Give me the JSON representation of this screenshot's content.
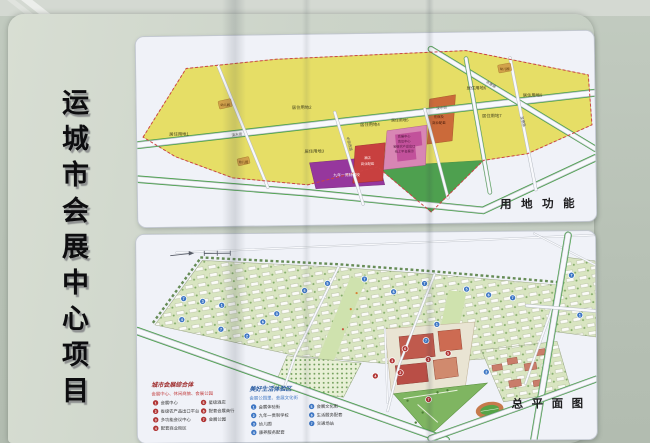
{
  "board": {
    "title": "运城市会展中心项目"
  },
  "land_use": {
    "panel_title": "用地功能",
    "residential": [
      "居住用地1",
      "居住用地2",
      "居住用地3",
      "居住用地4",
      "居住用地5",
      "居住用地6",
      "居住用地7",
      "居住用地9"
    ],
    "kindergarten": "幼儿园",
    "school": "九年一贯制学校",
    "hotel_line1": "酒店",
    "hotel_line2": "商业配套",
    "center_lines": [
      "会展中心",
      "会议中心",
      "省级农产品出口",
      "线上平台展示"
    ],
    "lodging_line1": "住宿及",
    "lodging_line2": "商业配套",
    "roads": {
      "sushui": "涑水街",
      "yonghui": "永惠路",
      "zhongyuan": "中原西路",
      "shenghui": "圣惠路"
    }
  },
  "site_plan": {
    "panel_title": "总平面图",
    "legend_red": {
      "title": "城市会展综合体",
      "subtitle": "会展中心、休闲商旅、会展公园",
      "items": [
        {
          "n": "1",
          "label": "会展中心"
        },
        {
          "n": "2",
          "label": "省级农产品出口平台"
        },
        {
          "n": "3",
          "label": "多功能会议中心"
        },
        {
          "n": "4",
          "label": "配套商业街区"
        },
        {
          "n": "5",
          "label": "星级酒店"
        },
        {
          "n": "6",
          "label": "配套会展商行"
        },
        {
          "n": "7",
          "label": "会展公园"
        }
      ]
    },
    "legend_blue": {
      "title": "美好生活体验区",
      "subtitle": "会展公园里、会展文化街",
      "items": [
        {
          "n": "1",
          "label": "会展体验街"
        },
        {
          "n": "2",
          "label": "九年一贯制学校"
        },
        {
          "n": "3",
          "label": "幼儿园"
        },
        {
          "n": "4",
          "label": "康养服务配套"
        },
        {
          "n": "5",
          "label": "会展文化街"
        },
        {
          "n": "6",
          "label": "生活服务配套"
        },
        {
          "n": "7",
          "label": "交通场站"
        }
      ]
    },
    "markers": {
      "blue": [
        {
          "n": "7",
          "x": 47,
          "y": 64
        },
        {
          "n": "3",
          "x": 66,
          "y": 67
        },
        {
          "n": "1",
          "x": 85,
          "y": 71
        },
        {
          "n": "4",
          "x": 45,
          "y": 85
        },
        {
          "n": "7",
          "x": 84,
          "y": 95
        },
        {
          "n": "2",
          "x": 110,
          "y": 102
        },
        {
          "n": "6",
          "x": 126,
          "y": 88
        },
        {
          "n": "3",
          "x": 140,
          "y": 80
        },
        {
          "n": "6",
          "x": 168,
          "y": 57
        },
        {
          "n": "5",
          "x": 191,
          "y": 50
        },
        {
          "n": "7",
          "x": 228,
          "y": 46
        },
        {
          "n": "6",
          "x": 257,
          "y": 59
        },
        {
          "n": "7",
          "x": 288,
          "y": 51
        },
        {
          "n": "1",
          "x": 300,
          "y": 92
        },
        {
          "n": "7",
          "x": 289,
          "y": 108
        },
        {
          "n": "5",
          "x": 330,
          "y": 57
        },
        {
          "n": "6",
          "x": 352,
          "y": 63
        },
        {
          "n": "7",
          "x": 376,
          "y": 66
        },
        {
          "n": "7",
          "x": 435,
          "y": 44
        },
        {
          "n": "1",
          "x": 443,
          "y": 84
        },
        {
          "n": "2",
          "x": 349,
          "y": 140
        }
      ],
      "red": [
        {
          "n": "6",
          "x": 268,
          "y": 116
        },
        {
          "n": "1",
          "x": 291,
          "y": 127
        },
        {
          "n": "5",
          "x": 311,
          "y": 121
        },
        {
          "n": "3",
          "x": 255,
          "y": 128
        },
        {
          "n": "2",
          "x": 263,
          "y": 140
        },
        {
          "n": "4",
          "x": 238,
          "y": 143
        },
        {
          "n": "7",
          "x": 291,
          "y": 167
        }
      ]
    }
  },
  "colors": {
    "residential_yellow": "#e6de66",
    "school_purple": "#96379d",
    "hotel_red": "#c8403f",
    "center_pink": "#d886b4",
    "lodging_orange": "#cb6a3a",
    "park_green": "#4ea04f",
    "marker_blue": "#3d76c4",
    "marker_red": "#b03434"
  }
}
